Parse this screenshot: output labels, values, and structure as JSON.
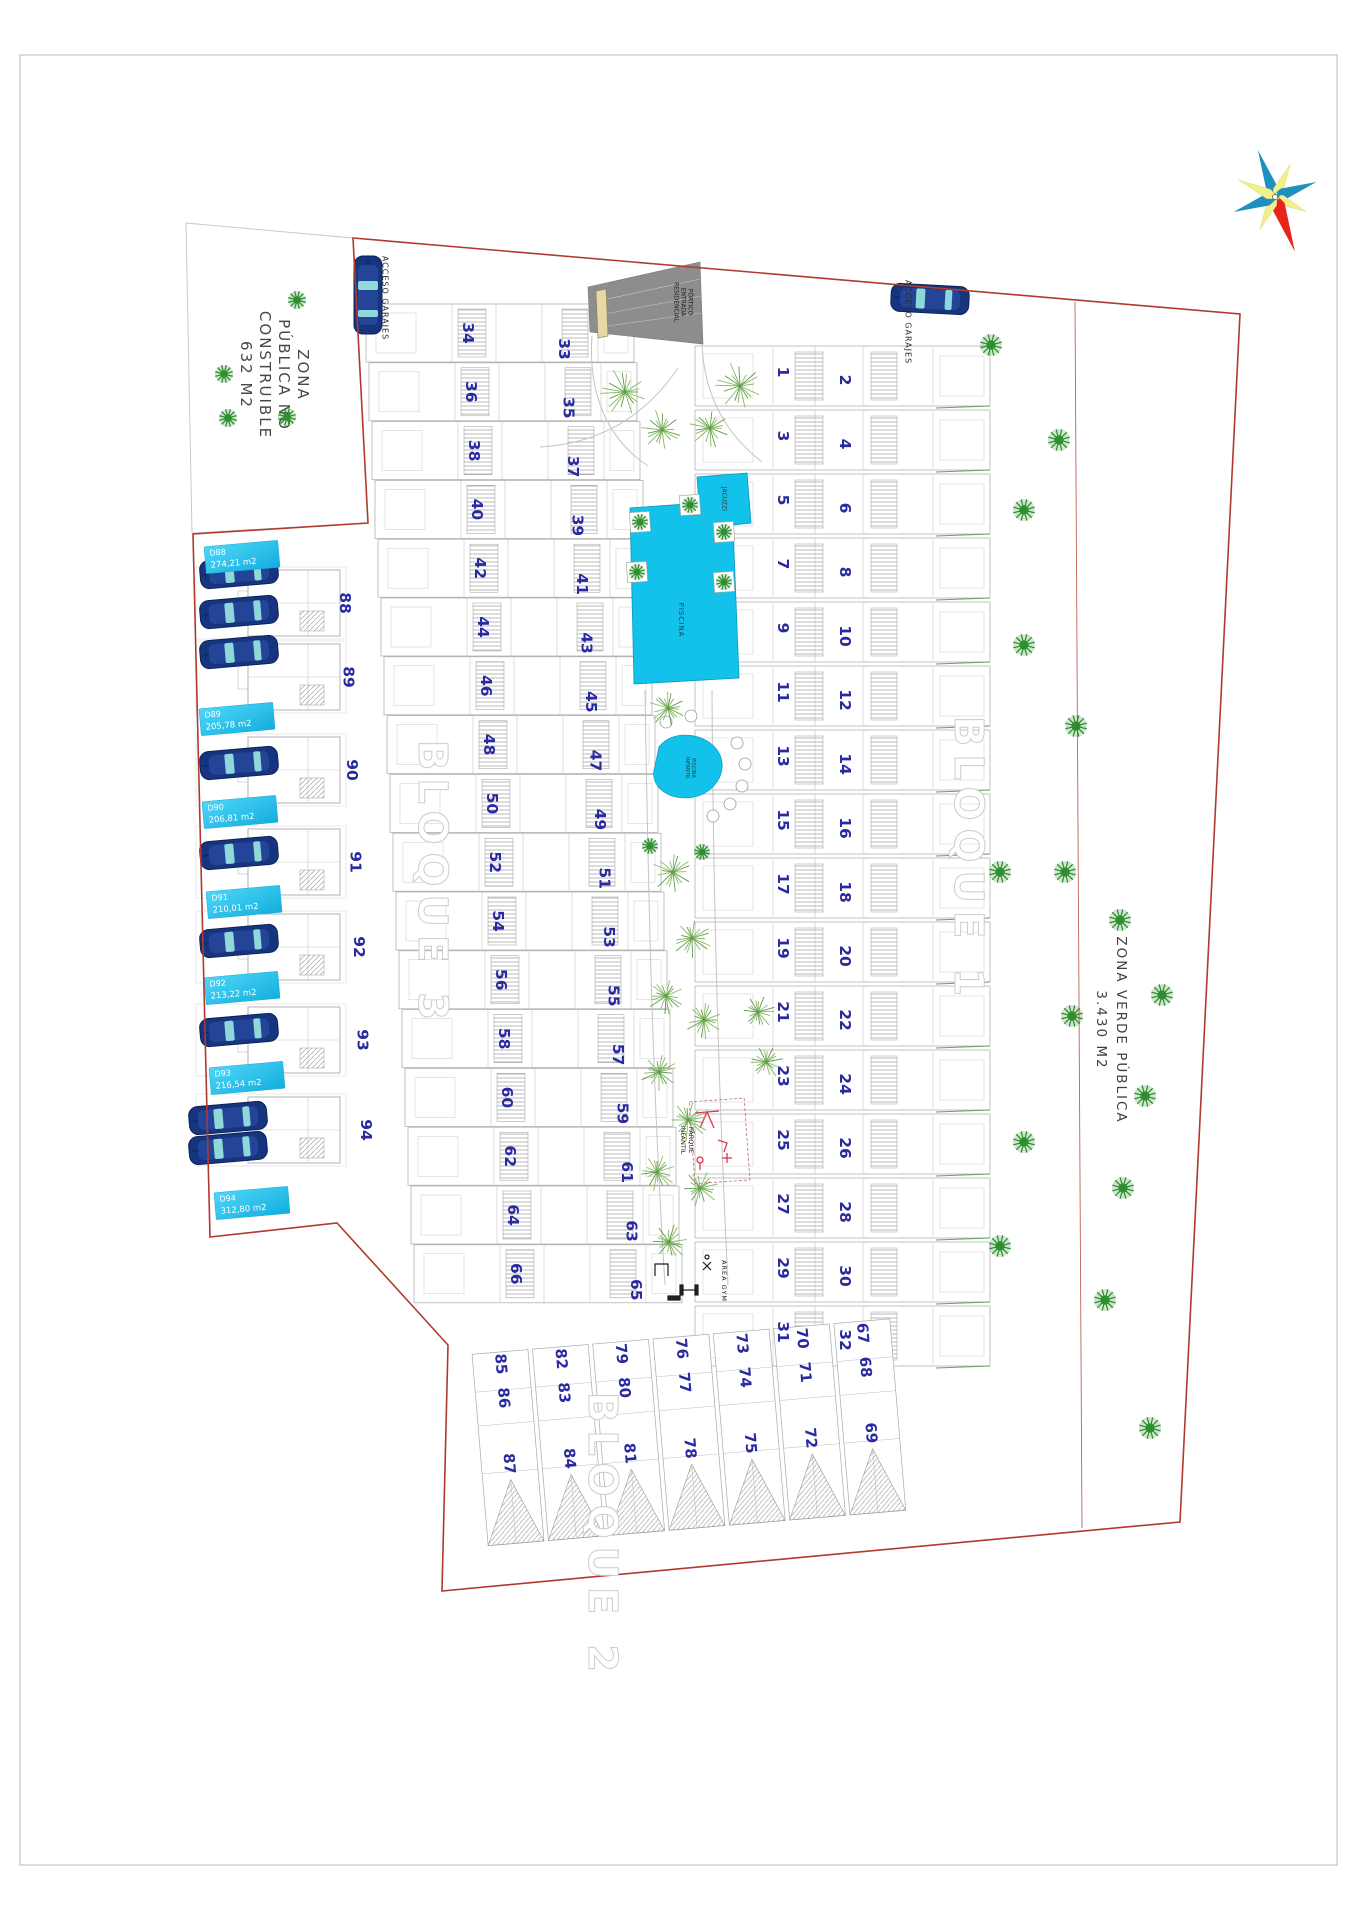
{
  "labels": {
    "zona_publica": {
      "lines": [
        "ZONA",
        "PÚBLICA NO",
        "CONSTRUIBLE",
        "632 M2"
      ]
    },
    "zona_verde": {
      "lines": [
        "ZONA VERDE PÚBLICA",
        "3.430 M2"
      ]
    },
    "acceso_garajes_left": "ACCESO GARAJES",
    "acceso_garajes_right": "ACCESO GARAJES",
    "portico": {
      "lines": [
        "PÓRTICO",
        "ENTRADA",
        "RESIDENCIAL"
      ]
    },
    "jacuzzi": "JACUZZI",
    "piscina": "PISCINA",
    "piscina_infantil": {
      "lines": [
        "PISCINA",
        "INFANTIL"
      ]
    },
    "parque_infantil": {
      "lines": [
        "PARQUE",
        "INFANTIL"
      ]
    },
    "area_gym": "AREA GYM",
    "bloque_1": "BLOQUE 1",
    "bloque_2": "BLOQUE 2",
    "bloque_3": "BLOQUE 3"
  },
  "plots": {
    "bloque1_left": [
      1,
      3,
      5,
      7,
      9,
      11,
      13,
      15,
      17,
      19,
      21,
      23,
      25,
      27,
      29,
      31
    ],
    "bloque1_right": [
      2,
      4,
      6,
      8,
      10,
      12,
      14,
      16,
      18,
      20,
      22,
      24,
      26,
      28,
      30,
      32
    ],
    "bloque3_left": [
      34,
      36,
      38,
      40,
      42,
      44,
      46,
      48,
      50,
      52,
      54,
      56,
      58,
      60,
      62,
      64,
      66
    ],
    "bloque3_right": [
      33,
      35,
      37,
      39,
      41,
      43,
      45,
      47,
      49,
      51,
      53,
      55,
      57,
      59,
      61,
      63,
      65
    ],
    "bloque2_columns": [
      [
        85,
        86,
        87
      ],
      [
        82,
        83,
        84
      ],
      [
        79,
        80,
        81
      ],
      [
        76,
        77,
        78
      ],
      [
        73,
        74,
        75
      ],
      [
        70,
        71,
        72
      ],
      [
        67,
        68,
        69
      ]
    ],
    "left_block": [
      88,
      89,
      90,
      91,
      92,
      93,
      94
    ]
  },
  "parcels": [
    {
      "code": "D88",
      "area": "274,21 m2"
    },
    {
      "code": "D89",
      "area": "205,78 m2"
    },
    {
      "code": "D90",
      "area": "206,81 m2"
    },
    {
      "code": "D91",
      "area": "210,01 m2"
    },
    {
      "code": "D92",
      "area": "213,22 m2"
    },
    {
      "code": "D93",
      "area": "216,54 m2"
    },
    {
      "code": "D94",
      "area": "312,80 m2"
    }
  ],
  "colors": {
    "pool": "#12c2ea",
    "pool_edge": "#0898c0",
    "boundary_red": "#b03a2e",
    "plot_number": "#2a2aa0",
    "parcel_box_light": "#4fd6f8",
    "parcel_box_dark": "#12aede",
    "tree_green": "#2f8f2f",
    "path_tree_green": "#86b763",
    "car_blue": "#17357f",
    "car_window": "#8fd8da",
    "hedge_green": "#5aa85a",
    "compass_red": "#e8231a",
    "compass_yellow": "#f2ef8d",
    "compass_blue": "#1f8fbf",
    "playground_red": "#e0344c"
  }
}
